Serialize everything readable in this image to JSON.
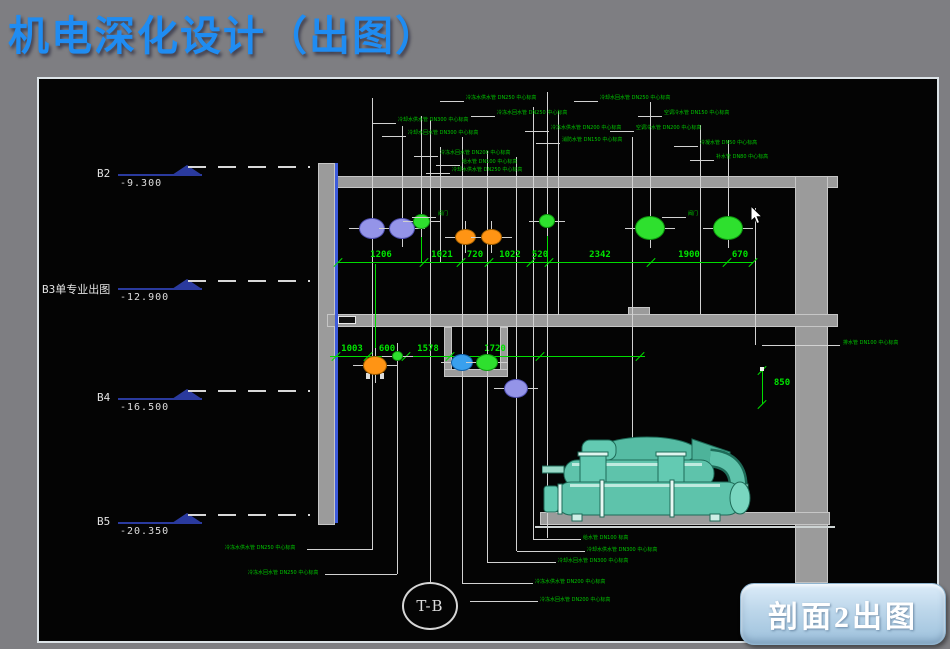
{
  "title": "机电深化设计（出图）",
  "button": {
    "label": "剖面2出图"
  },
  "grid_bubble": {
    "label": "T-B"
  },
  "levels": [
    {
      "name": "B2",
      "lx": 97,
      "elevation": "-9.300",
      "y": 175
    },
    {
      "name": "B3单专业出图",
      "lx": 42,
      "elevation": "-12.900",
      "y": 289
    },
    {
      "name": "B4",
      "lx": 97,
      "elevation": "-16.500",
      "y": 399
    },
    {
      "name": "B5",
      "lx": 97,
      "elevation": "-20.350",
      "y": 523
    }
  ],
  "dimensions": {
    "top_chain": {
      "y": 262,
      "x1": 338,
      "x2": 753,
      "ticks": [
        338,
        424,
        461,
        489,
        531,
        549,
        651,
        727,
        753
      ],
      "labels": [
        {
          "t": "1206",
          "x": 381
        },
        {
          "t": "1021",
          "x": 442
        },
        {
          "t": "720",
          "x": 475
        },
        {
          "t": "1022",
          "x": 510
        },
        {
          "t": "520",
          "x": 540
        },
        {
          "t": "2342",
          "x": 600
        },
        {
          "t": "1900",
          "x": 689
        },
        {
          "t": "670",
          "x": 740
        }
      ]
    },
    "mid_chain": {
      "y": 356,
      "x1": 330,
      "x2": 645,
      "ticks": [
        336,
        368,
        406,
        450,
        540,
        640
      ],
      "labels": [
        {
          "t": "1003",
          "x": 352
        },
        {
          "t": "600",
          "x": 387
        },
        {
          "t": "1578",
          "x": 428
        },
        {
          "t": "1720",
          "x": 495
        }
      ]
    },
    "vertical_dim": {
      "label": "850",
      "x": 762,
      "y1": 370,
      "y2": 404,
      "tx": 768,
      "ty": 378
    }
  },
  "pipes": [
    {
      "x": 372,
      "y": 228,
      "w": 26,
      "h": 21,
      "c": "purple"
    },
    {
      "x": 402,
      "y": 228,
      "w": 26,
      "h": 21,
      "c": "purple"
    },
    {
      "x": 421,
      "y": 221,
      "w": 17,
      "h": 15,
      "c": "green"
    },
    {
      "x": 465,
      "y": 237,
      "w": 21,
      "h": 16,
      "c": "orange"
    },
    {
      "x": 491,
      "y": 237,
      "w": 21,
      "h": 16,
      "c": "orange"
    },
    {
      "x": 547,
      "y": 221,
      "w": 16,
      "h": 14,
      "c": "green"
    },
    {
      "x": 650,
      "y": 228,
      "w": 30,
      "h": 24,
      "c": "green"
    },
    {
      "x": 728,
      "y": 228,
      "w": 30,
      "h": 24,
      "c": "green"
    },
    {
      "x": 375,
      "y": 365,
      "w": 24,
      "h": 19,
      "c": "orange",
      "base": true
    },
    {
      "x": 397,
      "y": 356,
      "w": 11,
      "h": 10,
      "c": "green"
    },
    {
      "x": 462,
      "y": 362,
      "w": 22,
      "h": 17,
      "c": "blue"
    },
    {
      "x": 487,
      "y": 362,
      "w": 22,
      "h": 17,
      "c": "green"
    },
    {
      "x": 516,
      "y": 388,
      "w": 24,
      "h": 19,
      "c": "purple"
    }
  ],
  "pipe_colors": {
    "purple": {
      "fill": "#9494e8",
      "stroke": "#5050b2"
    },
    "green": {
      "fill": "#2ee02e",
      "stroke": "#0f9a0f"
    },
    "orange": {
      "fill": "#ff9414",
      "stroke": "#a05e00"
    },
    "blue": {
      "fill": "#39a0ee",
      "stroke": "#1060a8"
    }
  },
  "walls": [
    {
      "x": 318,
      "y": 163,
      "w": 17,
      "h": 362
    },
    {
      "x": 335,
      "y": 176,
      "w": 503,
      "h": 12
    },
    {
      "x": 795,
      "y": 176,
      "w": 33,
      "h": 407
    },
    {
      "x": 327,
      "y": 314,
      "w": 511,
      "h": 13
    },
    {
      "x": 540,
      "y": 512,
      "w": 290,
      "h": 13
    },
    {
      "x": 444,
      "y": 327,
      "w": 8,
      "h": 50
    },
    {
      "x": 500,
      "y": 327,
      "w": 8,
      "h": 50
    },
    {
      "x": 444,
      "y": 369,
      "w": 64,
      "h": 8
    },
    {
      "x": 628,
      "y": 307,
      "w": 22,
      "h": 8
    }
  ],
  "graphics": {
    "blue_edge": {
      "x": 335,
      "y": 163,
      "w": 3,
      "h": 360,
      "color": "#3d5bdb"
    },
    "underline_slab": {
      "x": 535,
      "y": 526,
      "w": 300,
      "h": 2,
      "color": "#cdd3d3"
    },
    "white_box": {
      "x": 338,
      "y": 316,
      "w": 18,
      "h": 8
    },
    "v_lines": [
      {
        "x": 372,
        "y1": 98,
        "y2": 549
      },
      {
        "x": 402,
        "y1": 126,
        "y2": 242
      },
      {
        "x": 421,
        "y1": 116,
        "y2": 234
      },
      {
        "x": 430,
        "y1": 120,
        "y2": 583
      },
      {
        "x": 440,
        "y1": 147,
        "y2": 262
      },
      {
        "x": 462,
        "y1": 137,
        "y2": 583
      },
      {
        "x": 487,
        "y1": 151,
        "y2": 562
      },
      {
        "x": 516,
        "y1": 157,
        "y2": 551
      },
      {
        "x": 533,
        "y1": 107,
        "y2": 539
      },
      {
        "x": 547,
        "y1": 92,
        "y2": 538
      },
      {
        "x": 558,
        "y1": 111,
        "y2": 315
      },
      {
        "x": 632,
        "y1": 137,
        "y2": 478
      },
      {
        "x": 650,
        "y1": 102,
        "y2": 217
      },
      {
        "x": 700,
        "y1": 125,
        "y2": 314
      },
      {
        "x": 728,
        "y1": 140,
        "y2": 217
      },
      {
        "x": 755,
        "y1": 208,
        "y2": 345
      },
      {
        "x": 397,
        "y1": 362,
        "y2": 574
      }
    ],
    "h_lines": [
      {
        "y": 549,
        "x1": 307,
        "x2": 373
      },
      {
        "y": 574,
        "x1": 325,
        "x2": 397
      },
      {
        "y": 539,
        "x1": 533,
        "x2": 581
      },
      {
        "y": 551,
        "x1": 517,
        "x2": 585
      },
      {
        "y": 562,
        "x1": 487,
        "x2": 556
      },
      {
        "y": 583,
        "x1": 462,
        "x2": 533
      },
      {
        "y": 601,
        "x1": 470,
        "x2": 538
      },
      {
        "y": 345,
        "x1": 762,
        "x2": 840
      }
    ],
    "green_v_lines": [
      {
        "x": 375,
        "y1": 264,
        "y2": 354
      },
      {
        "x": 421,
        "y1": 232,
        "y2": 262
      },
      {
        "x": 547,
        "y1": 230,
        "y2": 262
      }
    ]
  },
  "annotations": {
    "top": [
      {
        "x": 466,
        "y": 95,
        "text": "冷冻水供水管 DN250 中心标高"
      },
      {
        "x": 497,
        "y": 110,
        "text": "冷冻水回水管 DN250 中心标高"
      },
      {
        "x": 398,
        "y": 117,
        "text": "冷却水供水管 DN300 中心标高"
      },
      {
        "x": 408,
        "y": 130,
        "text": "冷却水回水管 DN300 中心标高"
      },
      {
        "x": 551,
        "y": 125,
        "text": "冷冻水供水管 DN200 中心标高"
      },
      {
        "x": 562,
        "y": 137,
        "text": "消防水管 DN150 中心标高"
      },
      {
        "x": 440,
        "y": 150,
        "text": "冷冻水回水管 DN200 中心标高"
      },
      {
        "x": 462,
        "y": 159,
        "text": "给水管 DN100 中心标高"
      },
      {
        "x": 452,
        "y": 167,
        "text": "冷却水供水管 DN250 中心标高"
      },
      {
        "x": 600,
        "y": 95,
        "text": "冷却水回水管 DN250 中心标高"
      },
      {
        "x": 664,
        "y": 110,
        "text": "空调冷水管 DN150 中心标高"
      },
      {
        "x": 636,
        "y": 125,
        "text": "空调冷水管 DN200 中心标高"
      },
      {
        "x": 700,
        "y": 140,
        "text": "冷凝水管 DN50 中心标高"
      },
      {
        "x": 716,
        "y": 154,
        "text": "补水管 DN80 中心标高"
      },
      {
        "x": 438,
        "y": 211,
        "text": "阀门"
      },
      {
        "x": 688,
        "y": 211,
        "text": "阀门"
      }
    ],
    "bottom": [
      {
        "x": 225,
        "y": 545,
        "text": "冷冻水供水管 DN250 中心标高"
      },
      {
        "x": 248,
        "y": 570,
        "text": "冷冻水回水管 DN250 中心标高"
      },
      {
        "x": 583,
        "y": 535,
        "text": "给水管 DN100 标高"
      },
      {
        "x": 587,
        "y": 547,
        "text": "冷却水供水管 DN300 中心标高"
      },
      {
        "x": 558,
        "y": 558,
        "text": "冷却水回水管 DN300 中心标高"
      },
      {
        "x": 535,
        "y": 579,
        "text": "冷冻水供水管 DN200 中心标高"
      },
      {
        "x": 540,
        "y": 597,
        "text": "冷冻水回水管 DN200 中心标高"
      }
    ],
    "right": [
      {
        "x": 843,
        "y": 340,
        "text": "排水管 DN100 中心标高"
      }
    ]
  },
  "colors": {
    "background_gray": "#7e7e82",
    "canvas_black": "#040404",
    "title_blue": "#1f8cf2",
    "dimension_green": "#00e400",
    "annotation_green": "#00c800",
    "wall_gray": "#9b9b9b",
    "level_navy": "#2a3a9e",
    "machine_teal": "#5ec3ab",
    "button_blue": "#bcd6ea"
  }
}
